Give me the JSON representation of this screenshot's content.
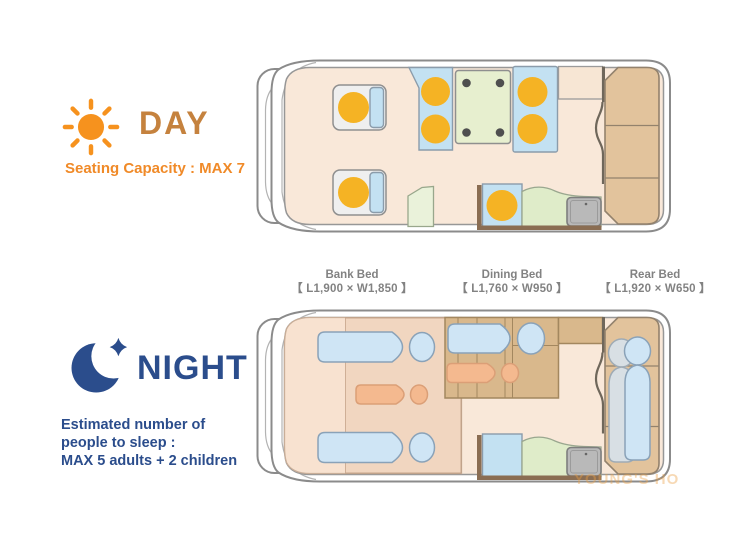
{
  "day": {
    "title": "DAY",
    "subtitle": "Seating Capacity : MAX 7"
  },
  "night": {
    "title": "NIGHT",
    "lines": [
      "Estimated number of",
      "people to sleep :",
      "MAX 5 adults + 2 children"
    ]
  },
  "beds": [
    {
      "name": "Bank Bed",
      "dimensions": "【 L1,900 × W1,850 】"
    },
    {
      "name": "Dining Bed",
      "dimensions": "【 L1,760 × W950 】"
    },
    {
      "name": "Rear Bed",
      "dimensions": "【 L1,920 × W650 】"
    }
  ],
  "watermark": "YOUNG'S HO",
  "icons": {
    "day": "sun-icon",
    "night": "moon-icon"
  },
  "colors": {
    "day_accent": "#c5823e",
    "day_orange": "#f08a28",
    "sun_orange": "#f6921e",
    "night_blue": "#2b4d8c",
    "label_gray": "#828282",
    "floor": "#f9e8d9",
    "bed_peach": "#f8e2d0",
    "seat_blue": "#c3e1f2",
    "cushion_orange": "#f5b324",
    "table_green": "#e7efcf",
    "counter_green": "#dfecc9",
    "bed_tan": "#e2c39c",
    "platform_tan": "#d9b88c",
    "sink_gray": "#b9b9b9",
    "adult_blue": "#cfe5f5",
    "adult_gray": "#d8dfe4",
    "child_orange": "#f4b98f",
    "watermark_color": "rgba(235,160,70,0.4)"
  }
}
